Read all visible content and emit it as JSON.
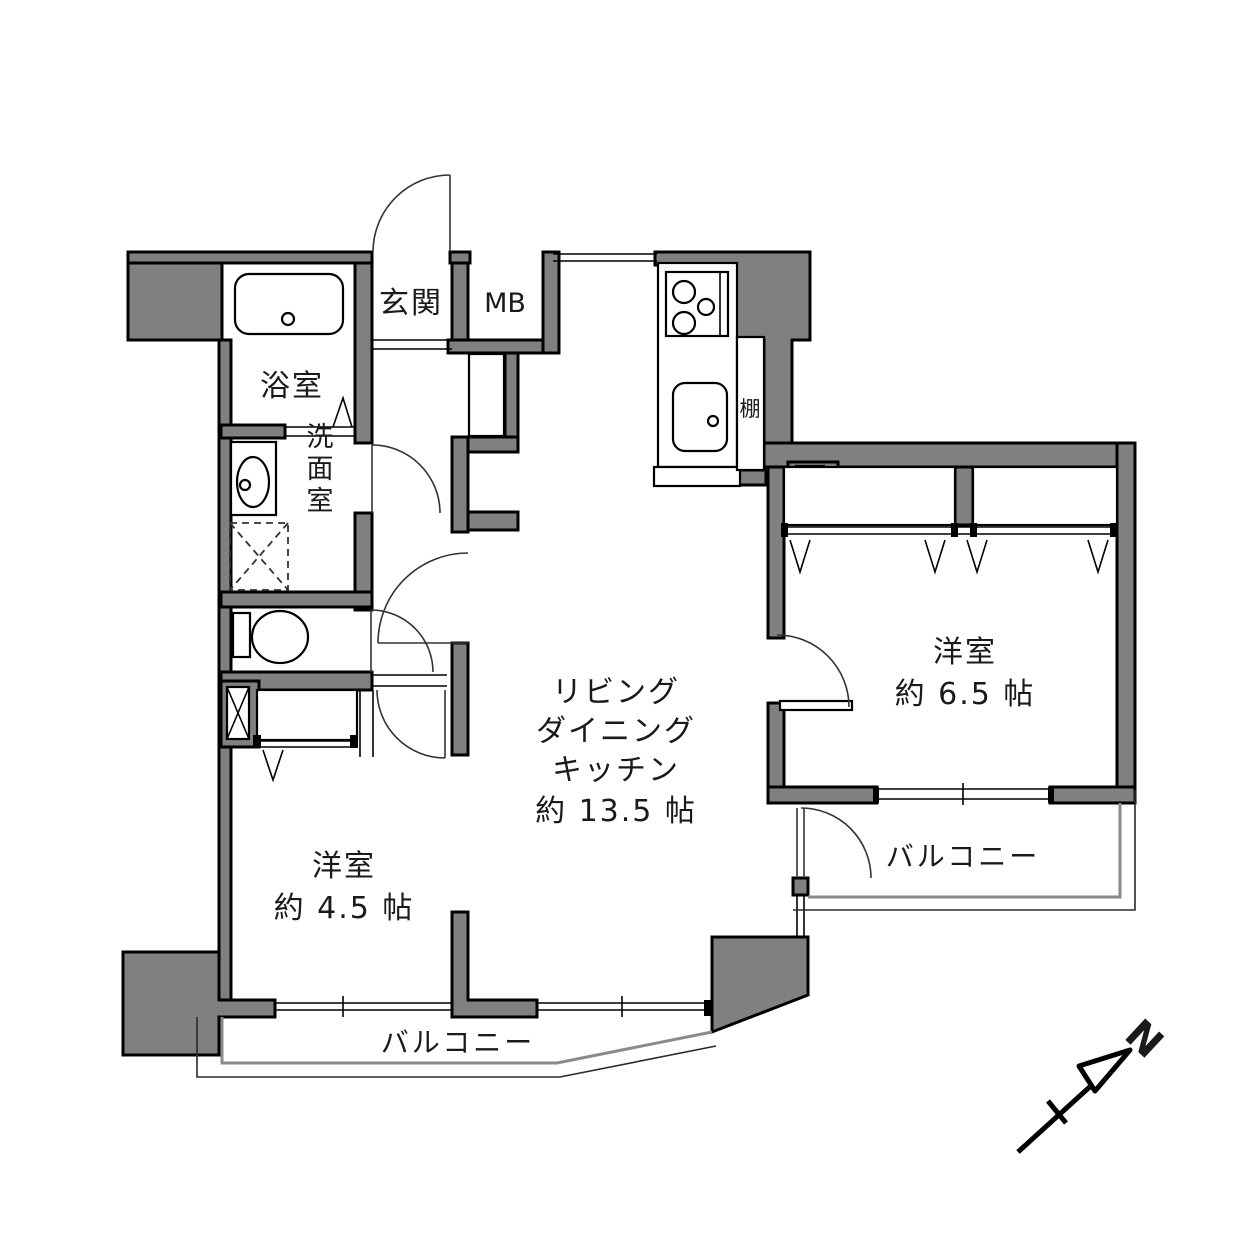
{
  "floorplan": {
    "rooms": {
      "bathroom": {
        "label": "浴室"
      },
      "entrance": {
        "label": "玄関"
      },
      "meter_box": {
        "label": "MB"
      },
      "washroom": {
        "label": "洗面室"
      },
      "shelf": {
        "label": "棚"
      },
      "ldk": {
        "lines": [
          "リビング",
          "ダイニング",
          "キッチン",
          "約 13.5 帖"
        ]
      },
      "bedroom_east": {
        "label": "洋室",
        "size": "約 6.5 帖"
      },
      "bedroom_west": {
        "label": "洋室",
        "size": "約 4.5 帖"
      },
      "balcony_south": {
        "label": "バルコニー"
      },
      "balcony_east": {
        "label": "バルコニー"
      }
    },
    "compass": {
      "north_label": "N"
    },
    "colors": {
      "wall_fill": "#808080",
      "outline": "#000000",
      "background": "#ffffff"
    }
  }
}
